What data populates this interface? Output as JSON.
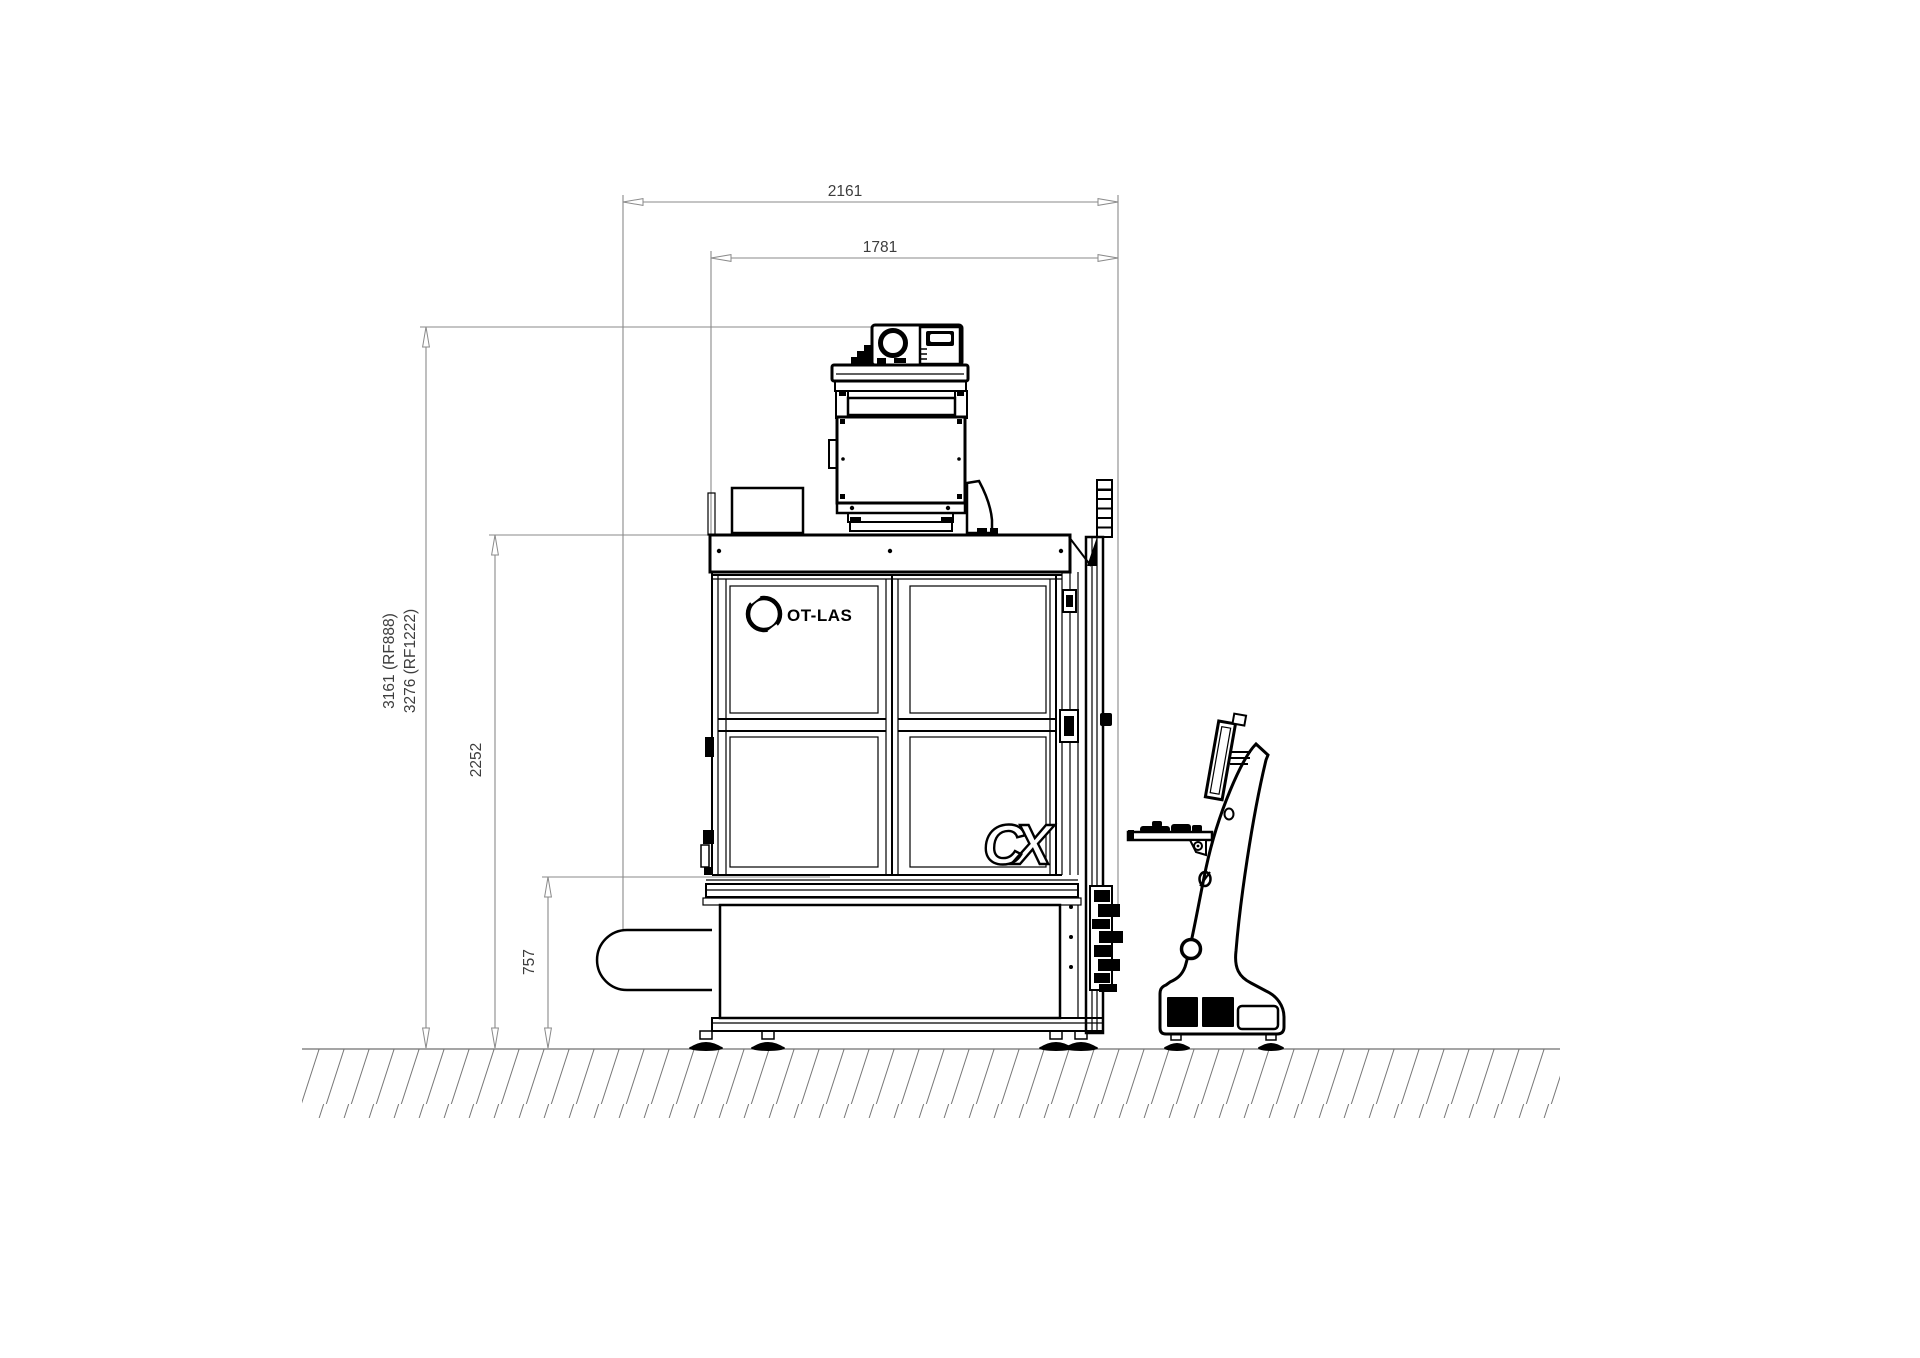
{
  "drawing": {
    "title": "OT-LAS CX laser system - side elevation with overall dimensions",
    "colors": {
      "background": "#ffffff",
      "machine_line": "#000000",
      "dimension_line": "#8a8a8a",
      "dimension_text": "#3d3d3d",
      "ground_hatch": "#777777"
    },
    "dimensions": {
      "width_overall": "2161",
      "width_body": "1781",
      "height_overall_rf888": "3161 (RF888)",
      "height_overall_rf1222": "3276 (RF1222)",
      "height_body": "2252",
      "height_exhaust_port": "757"
    },
    "branding": {
      "manufacturer_logo": "OT-LAS",
      "model_logo": "CX"
    }
  }
}
